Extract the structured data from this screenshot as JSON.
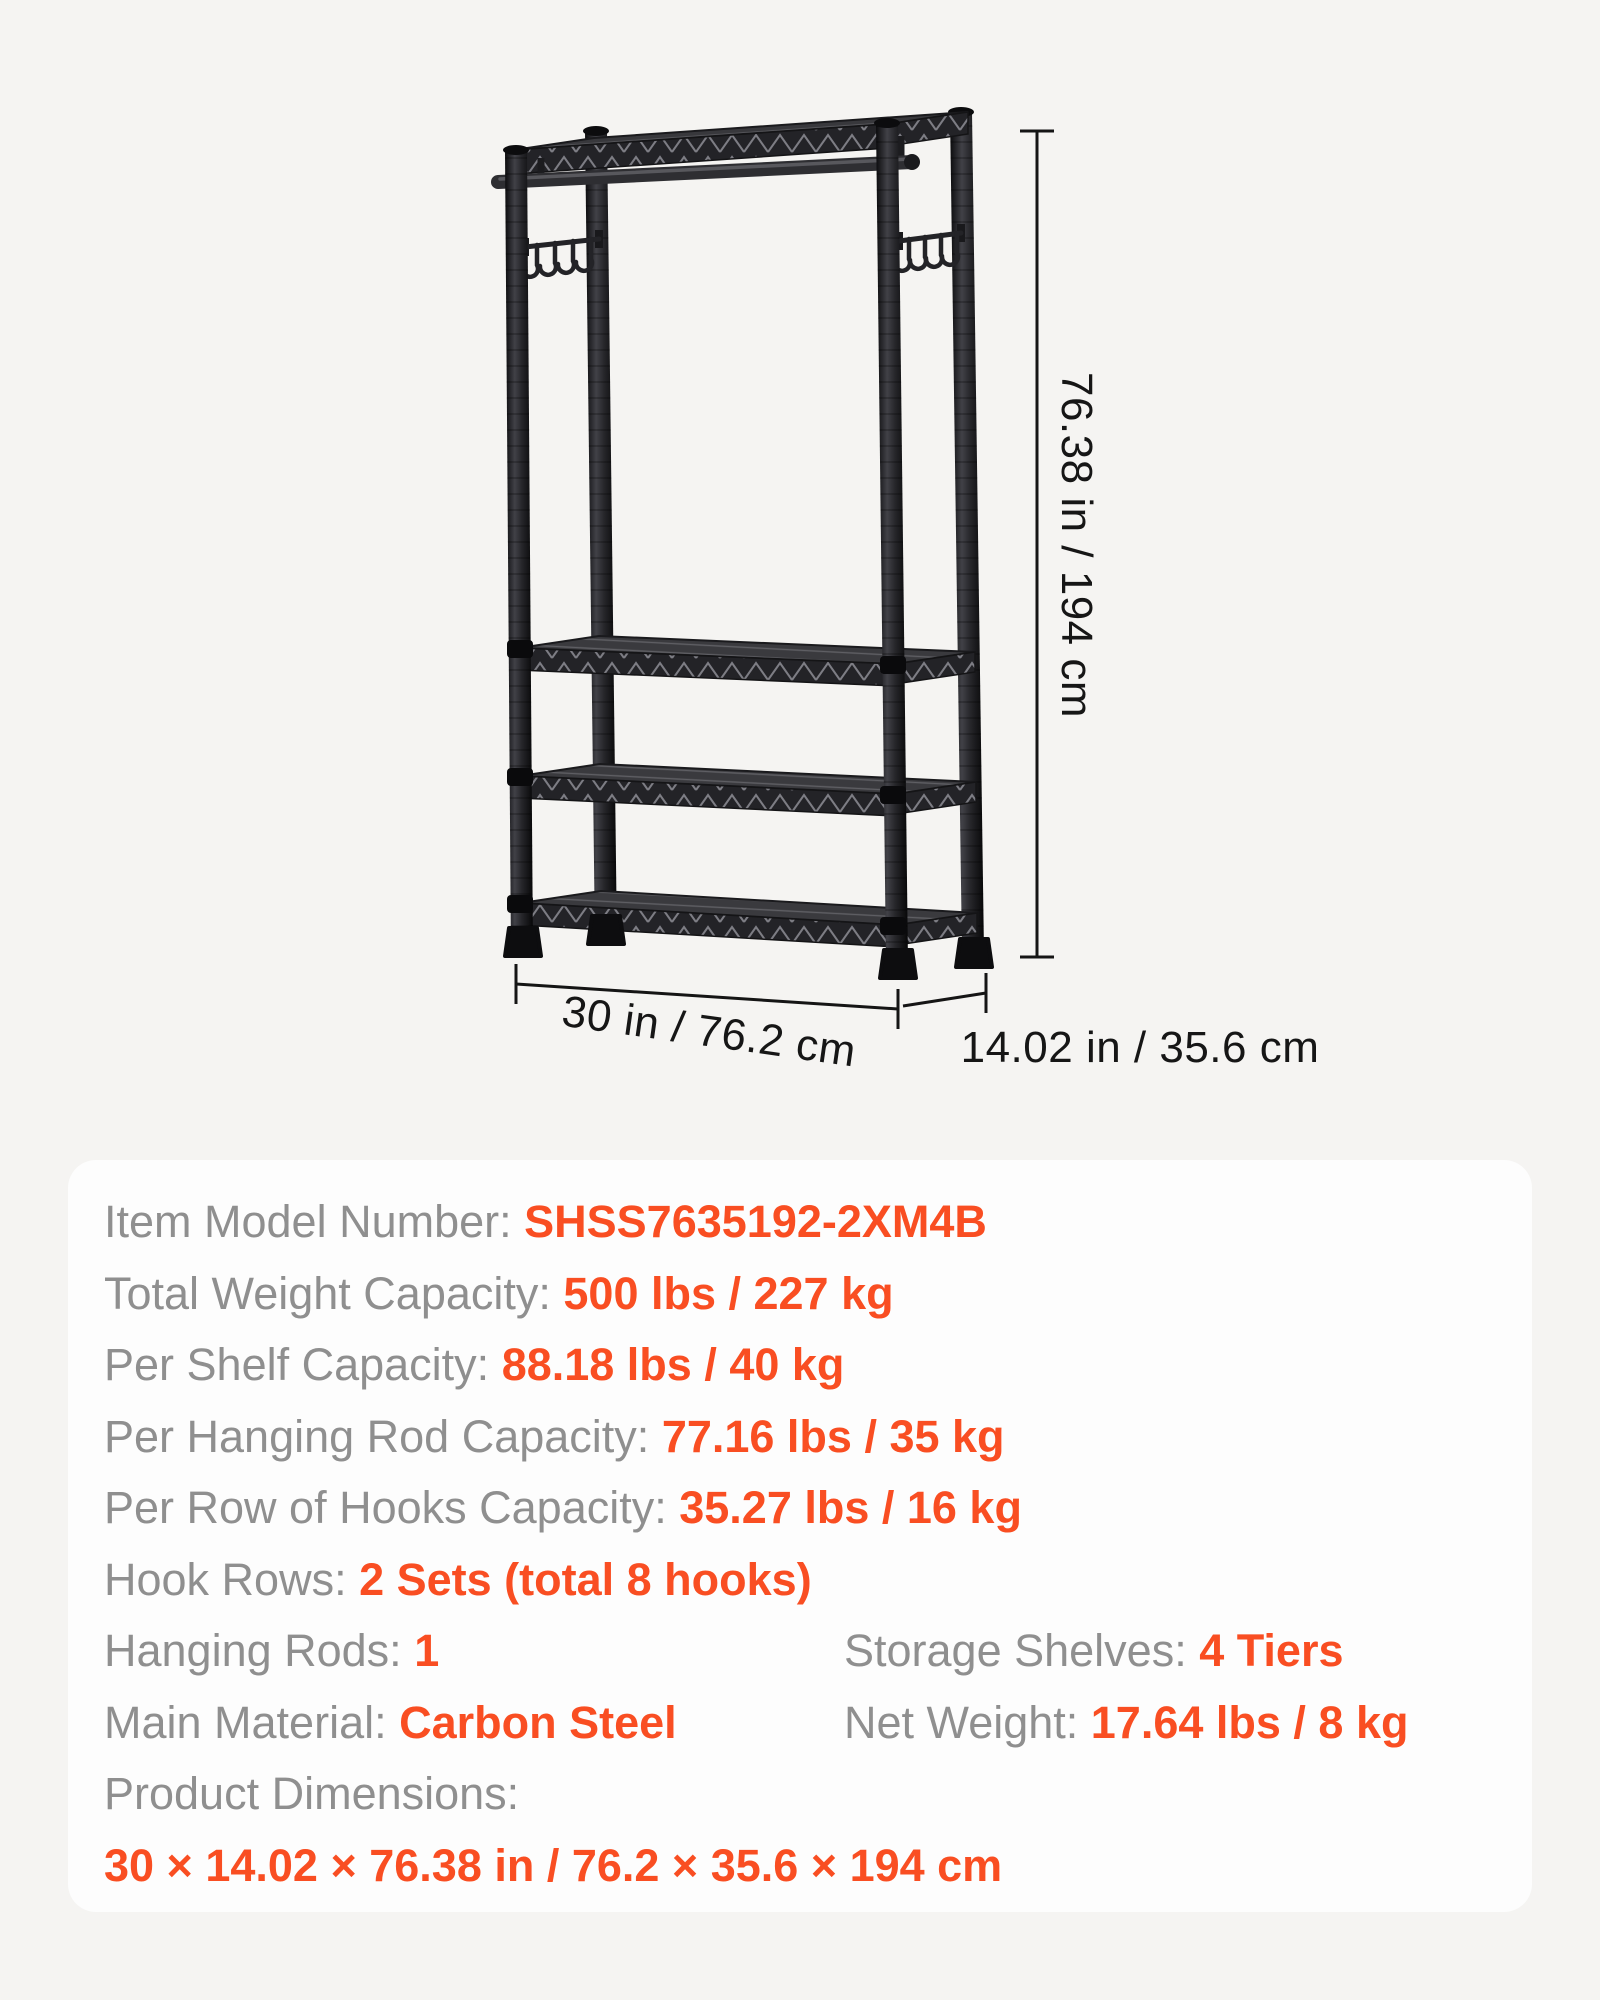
{
  "page": {
    "background_color": "#f5f4f2",
    "panel_background": "#fdfdfd",
    "label_color": "#8f8f8f",
    "value_color": "#f94e22"
  },
  "product_figure": {
    "description": "Black 4-tier wire garment rack with top shelf, hanging rod and two side hook rows",
    "frame_color": "#1b1b1e",
    "annotations": {
      "height": "76.38 in / 194 cm",
      "width": "30 in / 76.2 cm",
      "depth": "14.02 in / 35.6 cm"
    }
  },
  "spec_panel": {
    "rows": [
      {
        "label": "Item Model Number: ",
        "value": "SHSS7635192-2XM4B"
      },
      {
        "label": "Total Weight Capacity: ",
        "value": "500 lbs / 227 kg"
      },
      {
        "label": "Per Shelf Capacity: ",
        "value": "88.18 lbs / 40 kg"
      },
      {
        "label": "Per Hanging Rod Capacity: ",
        "value": "77.16 lbs / 35 kg"
      },
      {
        "label": "Per Row of Hooks Capacity: ",
        "value": "35.27 lbs / 16 kg"
      },
      {
        "label": "Hook Rows: ",
        "value": "2 Sets (total 8 hooks)"
      }
    ],
    "pair_rows": [
      [
        {
          "label": "Hanging Rods: ",
          "value": "1"
        },
        {
          "label": "Storage Shelves: ",
          "value": "4 Tiers"
        }
      ],
      [
        {
          "label": "Main Material: ",
          "value": "Carbon Steel"
        },
        {
          "label": "Net Weight: ",
          "value": "17.64 lbs / 8 kg"
        }
      ]
    ],
    "dimensions_label": "Product Dimensions:",
    "dimensions_value": "30 × 14.02 × 76.38 in / 76.2 × 35.6 × 194 cm"
  }
}
